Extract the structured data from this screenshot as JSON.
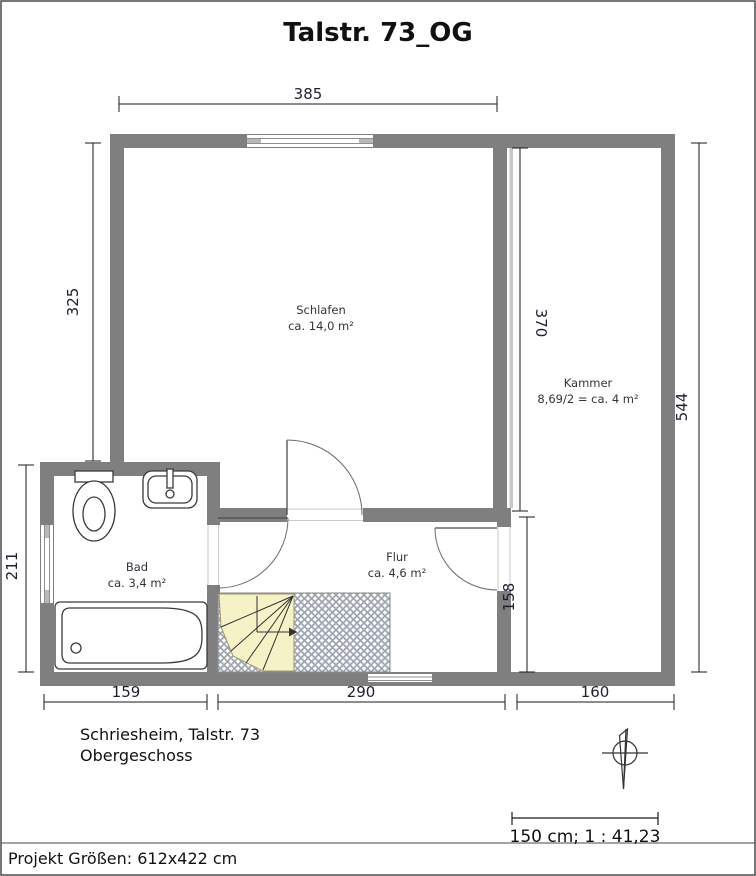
{
  "title": "Talstr. 73_OG",
  "rooms": {
    "schlafen": {
      "name": "Schlafen",
      "area": "ca. 14,0 m²"
    },
    "kammer": {
      "name": "Kammer",
      "area": "8,69/2 = ca. 4 m²"
    },
    "bad": {
      "name": "Bad",
      "area": "ca. 3,4 m²"
    },
    "flur": {
      "name": "Flur",
      "area": "ca. 4,6 m²"
    }
  },
  "dims": {
    "schlafen_width": "385",
    "schlafen_height": "325",
    "bad_height": "211",
    "kammer_inner_height": "370",
    "right_total_height": "544",
    "flur_height": "158",
    "bottom_bad_width": "159",
    "bottom_flur_width": "290",
    "bottom_kammer_width": "160"
  },
  "footer": {
    "address": "Schriesheim, Talstr. 73",
    "floor": "Obergeschoss",
    "scale": "150 cm; 1 : 41,23",
    "project_size": "Projekt Größen: 612x422 cm"
  },
  "colors": {
    "wall": "#7f7f7f",
    "knee_wall": "#c8c8c8",
    "stair_fill": "#f6f2c8",
    "hatch_line": "#a0a6b2",
    "dimension_text": "#1c2030"
  }
}
